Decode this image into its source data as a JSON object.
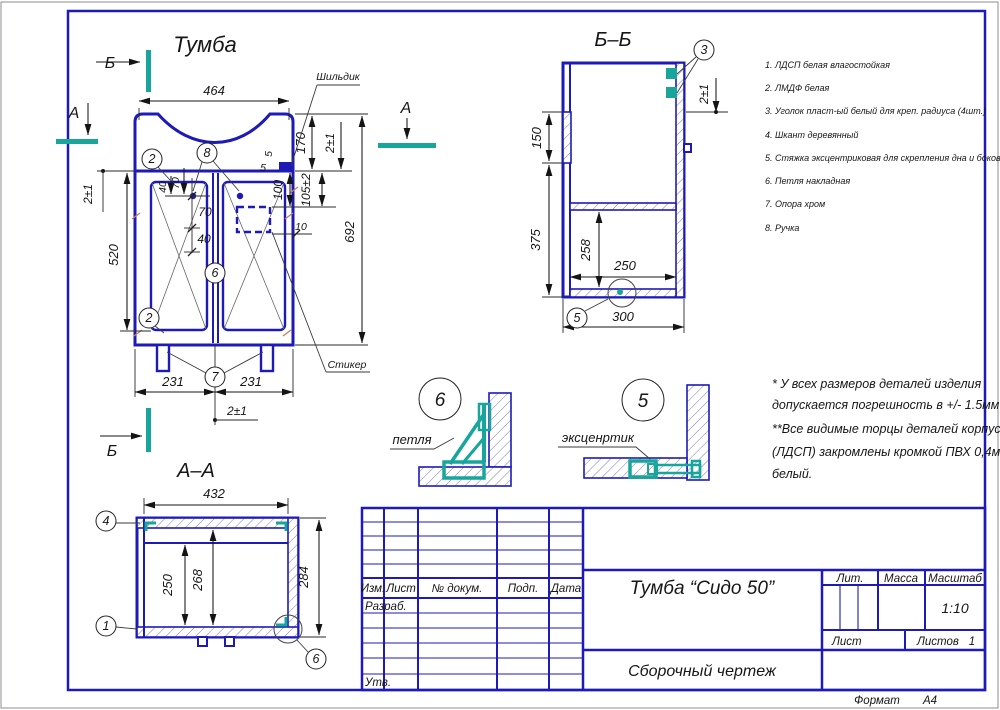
{
  "colors": {
    "blue": "#1d1ab8",
    "teal": "#17a59c",
    "hatch": "#7a7ac8",
    "orange": "#c97f5a",
    "ink": "#161616"
  },
  "page": {
    "format_label": "Формат",
    "format_value": "А4"
  },
  "front_view": {
    "title": "Тумба",
    "section_marker_a": "А",
    "section_marker_b": "Б",
    "label_shildik": "Шильдик",
    "label_sticker": "Стикер",
    "dims": {
      "width": "464",
      "overall_height": "692",
      "top_panel": "170",
      "gap_top_right": "2±1",
      "gap_top_left": "2±1",
      "door_height": "520",
      "handle_off1": "40",
      "handle_off2": "70",
      "handle_down1": "70",
      "handle_down2": "40",
      "plate_off_side": "5",
      "plate_off_top": "5",
      "plate_down": "100",
      "sticker_down": "105±2",
      "sticker_side": "10",
      "leg_left": "231",
      "leg_right": "231",
      "center_gap": "2±1"
    },
    "callouts": {
      "door_top": "2",
      "handle": "8",
      "body": "6",
      "door_bottom": "2",
      "leg": "7"
    }
  },
  "section_bb": {
    "title": "Б–Б",
    "dims": {
      "hinge_zone": "150",
      "lower": "375",
      "shelf_to_bottom": "258",
      "inner_depth": "250",
      "depth": "300",
      "door_overhang": "2±1"
    },
    "callouts": {
      "bracket": "3",
      "cam": "5"
    }
  },
  "section_aa": {
    "title": "А–А",
    "dims": {
      "inner_width": "432",
      "inner_clear": "250",
      "back": "268",
      "height": "284"
    },
    "callouts": {
      "top": "4",
      "side": "1",
      "hinge": "6"
    }
  },
  "detail_hinge": {
    "number": "6",
    "label": "петля"
  },
  "detail_cam": {
    "number": "5",
    "label": "эксценртик"
  },
  "parts_list": {
    "items": [
      "1. ЛДСП белая влагостойкая",
      "2. ЛМДФ белая",
      "3. Уголок пласт-ый белый для креп. радиуса (4шт.)",
      "4. Шкант деревянный",
      "5. Стяжка эксцентриковая для скрепления дна и боковин",
      "6. Петля накладная",
      "7. Опора хром",
      "8. Ручка"
    ]
  },
  "notes": {
    "lines": [
      "* У всех размеров деталей изделия",
      "допускается погрешность в +/- 1.5мм",
      "**Все видимые торцы деталей корпуса",
      "(ЛДСП) закромлены кромкой ПВХ 0,4мм",
      "белый."
    ]
  },
  "title_block": {
    "col_izm": "Изм.",
    "col_sheet": "Лист",
    "col_doc": "№ докум.",
    "col_sign": "Подп.",
    "col_date": "Дата",
    "row_razrab": "Разраб.",
    "row_utv": "Утв.",
    "product": "Тумба “Сидо 50”",
    "doc_type": "Сборочный чертеж",
    "lit": "Лит.",
    "mass": "Масса",
    "scale_label": "Масштаб",
    "scale": "1:10",
    "sheet_label": "Лист",
    "sheets_label": "Листов",
    "sheets_value": "1"
  }
}
